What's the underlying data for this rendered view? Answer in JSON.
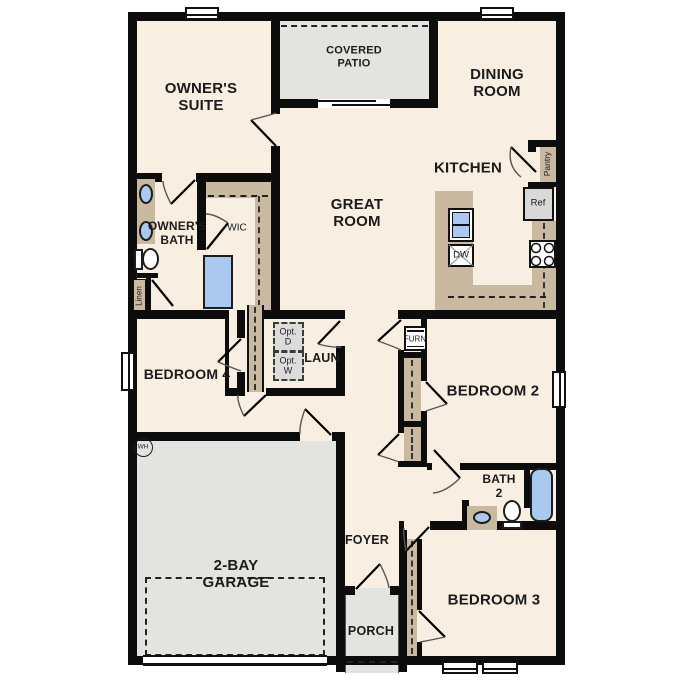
{
  "colors": {
    "floor": "#f8efe2",
    "wall": "#0c0c0c",
    "counter": "#c8b9a0",
    "fixture": "#abc9ee",
    "concrete": "#e3e3e0",
    "optional": "#dcdcdc",
    "door_arc": "#555555"
  },
  "rooms": {
    "covered_patio": "COVERED\nPATIO",
    "owners_suite": "OWNER'S\nSUITE",
    "dining_room": "DINING\nROOM",
    "great_room": "GREAT\nROOM",
    "kitchen": "KITCHEN",
    "owners_bath": "OWNER'S\nBATH",
    "wic": "WIC",
    "laundry": "LAUN",
    "bedroom4": "BEDROOM 4",
    "bedroom2": "BEDROOM 2",
    "bath2": "BATH\n2",
    "bedroom3": "BEDROOM 3",
    "foyer": "FOYER",
    "porch": "PORCH",
    "garage": "2-BAY\nGARAGE"
  },
  "fixtures": {
    "pantry": "Pantry",
    "ref": "Ref",
    "dw": "DW",
    "furn": "FURN",
    "linen": "Linen",
    "opt_dryer": "Opt.\nD",
    "opt_washer": "Opt.\nW",
    "water_heater": "WH"
  }
}
